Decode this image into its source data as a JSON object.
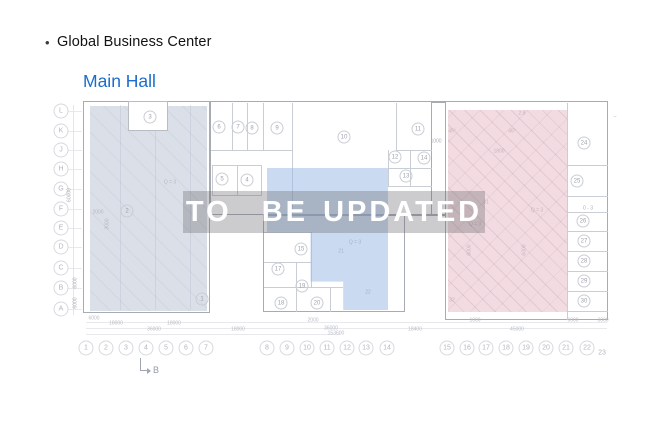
{
  "header": {
    "bullet": "•",
    "title": "Global Business Center",
    "hall": "Main Hall"
  },
  "watermark": {
    "text": "TO  BE UPDATED"
  },
  "colors": {
    "hall_link": "#1a6dcc",
    "overlay_left": "rgba(183,193,209,0.5)",
    "overlay_center": "rgba(153,185,229,0.52)",
    "overlay_right": "rgba(229,185,197,0.5)",
    "watermark_bg": "rgba(99,101,106,0.33)",
    "watermark_text": "#ffffff"
  },
  "plan": {
    "section_label": "B",
    "row_labels": [
      {
        "t": "L",
        "y": 111
      },
      {
        "t": "K",
        "y": 131
      },
      {
        "t": "J",
        "y": 150
      },
      {
        "t": "H",
        "y": 169
      },
      {
        "t": "G",
        "y": 189
      },
      {
        "t": "F",
        "y": 209
      },
      {
        "t": "E",
        "y": 228
      },
      {
        "t": "D",
        "y": 247
      },
      {
        "t": "C",
        "y": 268
      },
      {
        "t": "B",
        "y": 288
      },
      {
        "t": "A",
        "y": 309
      }
    ],
    "col_labels": [
      {
        "t": "1",
        "x": 86
      },
      {
        "t": "2",
        "x": 106
      },
      {
        "t": "3",
        "x": 126
      },
      {
        "t": "4",
        "x": 146
      },
      {
        "t": "5",
        "x": 166
      },
      {
        "t": "6",
        "x": 186
      },
      {
        "t": "7",
        "x": 206
      },
      {
        "t": "8",
        "x": 267
      },
      {
        "t": "9",
        "x": 287
      },
      {
        "t": "10",
        "x": 307
      },
      {
        "t": "11",
        "x": 327
      },
      {
        "t": "12",
        "x": 347
      },
      {
        "t": "13",
        "x": 366
      },
      {
        "t": "14",
        "x": 387
      },
      {
        "t": "15",
        "x": 447
      },
      {
        "t": "16",
        "x": 467
      },
      {
        "t": "17",
        "x": 486
      },
      {
        "t": "18",
        "x": 506
      },
      {
        "t": "19",
        "x": 526
      },
      {
        "t": "20",
        "x": 546
      },
      {
        "t": "21",
        "x": 566
      },
      {
        "t": "22",
        "x": 587
      },
      {
        "t": "23",
        "x": 602,
        "plain": true,
        "y": 353
      }
    ],
    "rooms": [
      {
        "n": "1",
        "x": 202,
        "y": 299
      },
      {
        "n": "2",
        "x": 127,
        "y": 211
      },
      {
        "n": "3",
        "x": 150,
        "y": 117
      },
      {
        "n": "5",
        "x": 222,
        "y": 179
      },
      {
        "n": "4",
        "x": 247,
        "y": 180
      },
      {
        "n": "6",
        "x": 219,
        "y": 127
      },
      {
        "n": "7",
        "x": 238,
        "y": 127
      },
      {
        "n": "8",
        "x": 252,
        "y": 128
      },
      {
        "n": "9",
        "x": 277,
        "y": 128
      },
      {
        "n": "10",
        "x": 344,
        "y": 137
      },
      {
        "n": "11",
        "x": 418,
        "y": 129
      },
      {
        "n": "12",
        "x": 395,
        "y": 157
      },
      {
        "n": "13",
        "x": 406,
        "y": 176
      },
      {
        "n": "14",
        "x": 424,
        "y": 158
      },
      {
        "n": "15",
        "x": 301,
        "y": 249
      },
      {
        "n": "17",
        "x": 278,
        "y": 269
      },
      {
        "n": "18",
        "x": 281,
        "y": 303
      },
      {
        "n": "19",
        "x": 302,
        "y": 286
      },
      {
        "n": "20",
        "x": 317,
        "y": 303
      },
      {
        "n": "24",
        "x": 584,
        "y": 143
      },
      {
        "n": "25",
        "x": 577,
        "y": 181
      },
      {
        "n": "26",
        "x": 583,
        "y": 221
      },
      {
        "n": "27",
        "x": 584,
        "y": 241
      },
      {
        "n": "28",
        "x": 584,
        "y": 261
      },
      {
        "n": "29",
        "x": 584,
        "y": 281
      },
      {
        "n": "30",
        "x": 584,
        "y": 301
      }
    ],
    "texts": [
      {
        "t": "Q = 3",
        "x": 170,
        "y": 183
      },
      {
        "t": "2000",
        "x": 98,
        "y": 213
      },
      {
        "t": "3000",
        "x": 108,
        "y": 224,
        "v": true
      },
      {
        "t": "60000",
        "x": 70,
        "y": 195,
        "v": true
      },
      {
        "t": "6000",
        "x": 76,
        "y": 283,
        "v": true
      },
      {
        "t": "6000",
        "x": 76,
        "y": 303,
        "v": true
      },
      {
        "t": "Q = 3",
        "x": 355,
        "y": 243
      },
      {
        "t": "21",
        "x": 341,
        "y": 252
      },
      {
        "t": "22",
        "x": 368,
        "y": 293
      },
      {
        "t": "2.8",
        "x": 522,
        "y": 114
      },
      {
        "t": "45°",
        "x": 452,
        "y": 132
      },
      {
        "t": "45°",
        "x": 512,
        "y": 132
      },
      {
        "t": "1000",
        "x": 436,
        "y": 142
      },
      {
        "t": "1800",
        "x": 499,
        "y": 152
      },
      {
        "t": "6000",
        "x": 470,
        "y": 250,
        "v": true
      },
      {
        "t": "6000",
        "x": 525,
        "y": 250,
        "v": true
      },
      {
        "t": "Q = 3",
        "x": 537,
        "y": 211
      },
      {
        "t": "Q = 3",
        "x": 475,
        "y": 225
      },
      {
        "t": "31",
        "x": 486,
        "y": 203
      },
      {
        "t": "32",
        "x": 452,
        "y": 301
      },
      {
        "t": "0 - 3",
        "x": 588,
        "y": 209
      },
      {
        "t": "–",
        "x": 615,
        "y": 117
      }
    ],
    "dims": [
      {
        "t": "6000",
        "x": 94,
        "y": 319
      },
      {
        "t": "18000",
        "x": 116,
        "y": 324
      },
      {
        "t": "18000",
        "x": 174,
        "y": 324
      },
      {
        "t": "36000",
        "x": 154,
        "y": 330
      },
      {
        "t": "18000",
        "x": 238,
        "y": 330
      },
      {
        "t": "2000",
        "x": 313,
        "y": 321
      },
      {
        "t": "36000",
        "x": 331,
        "y": 329
      },
      {
        "t": "153600",
        "x": 336,
        "y": 334
      },
      {
        "t": "1000",
        "x": 475,
        "y": 321
      },
      {
        "t": "18400",
        "x": 415,
        "y": 330
      },
      {
        "t": "45000",
        "x": 517,
        "y": 330
      },
      {
        "t": "6000",
        "x": 573,
        "y": 321
      },
      {
        "t": "3000",
        "x": 603,
        "y": 321
      }
    ]
  }
}
